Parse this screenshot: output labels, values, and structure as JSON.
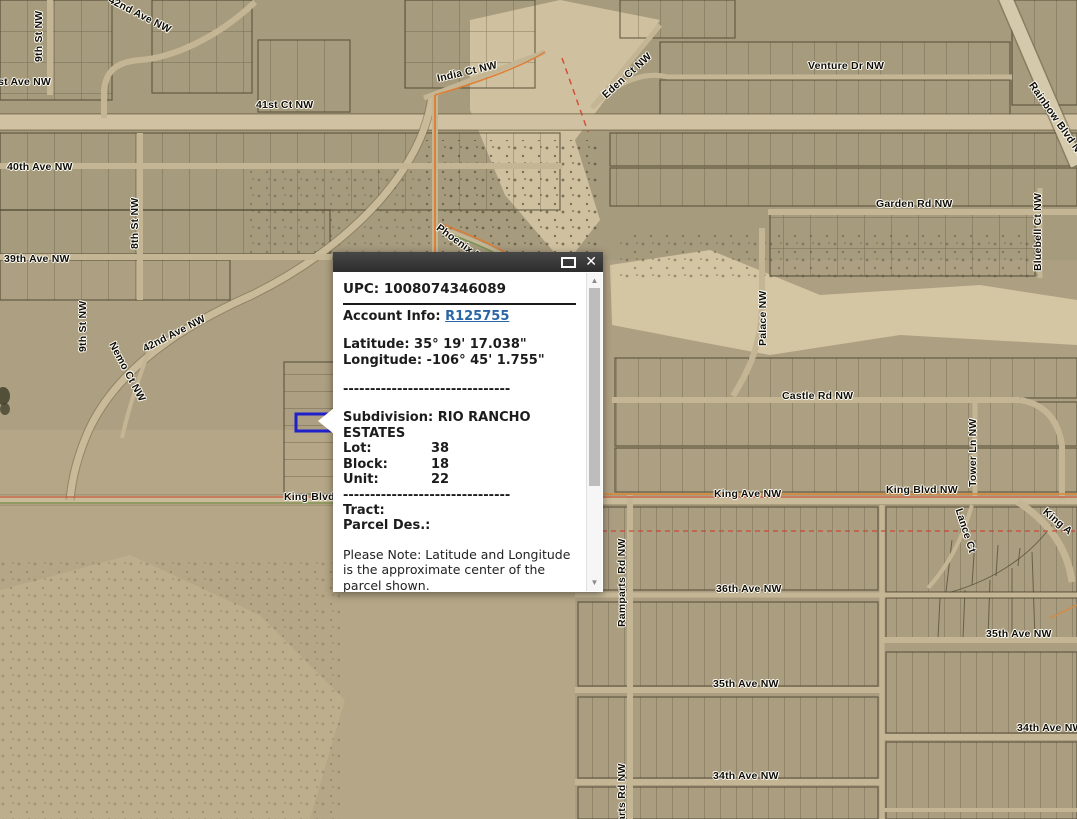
{
  "app": {
    "type": "parcel-map-viewer"
  },
  "popup": {
    "upc_line": "UPC: 1008074346089",
    "account_info_label": "Account Info:",
    "account_info_link": "R125755",
    "latitude_line": "Latitude: 35° 19' 17.038\"",
    "longitude_line": "Longitude: -106° 45' 1.755\"",
    "separator": "-------------------------------",
    "subdivision_label": "Subdivision:",
    "subdivision_value": "RIO RANCHO ESTATES",
    "fields": [
      {
        "label": "Lot:",
        "value": "38"
      },
      {
        "label": "Block:",
        "value": "18"
      },
      {
        "label": "Unit:",
        "value": "22"
      }
    ],
    "tract_label": "Tract:",
    "parcel_des_label": "Parcel Des.:",
    "note": "Please Note: Latitude and Longitude is the approximate center of the parcel shown.",
    "icons": {
      "maximize": "restore-window-icon",
      "close_glyph": "✕",
      "scroll_up_glyph": "▲",
      "scroll_down_glyph": "▼"
    },
    "colors": {
      "titlebar": "#3a3a3a",
      "link": "#2a66a5"
    }
  },
  "map": {
    "highlight_color": "#2121cc",
    "labels": [
      {
        "text": "9th St NW",
        "x": 33,
        "y": 62,
        "r": -90
      },
      {
        "text": "42nd Ave NW",
        "x": 112,
        "y": -6,
        "r": 27
      },
      {
        "text": "41st Ave NW",
        "x": -14,
        "y": 76,
        "r": 0
      },
      {
        "text": "41st Ct NW",
        "x": 256,
        "y": 99,
        "r": 0
      },
      {
        "text": "India Ct NW",
        "x": 436,
        "y": 73,
        "r": -13
      },
      {
        "text": "Eden Ct NW",
        "x": 600,
        "y": 92,
        "r": -42
      },
      {
        "text": "Venture Dr NW",
        "x": 808,
        "y": 60,
        "r": 0
      },
      {
        "text": "Rainbow Blvd NW",
        "x": 1036,
        "y": 80,
        "r": 55
      },
      {
        "text": "40th Ave NW",
        "x": 7,
        "y": 161,
        "r": 0
      },
      {
        "text": "8th St NW",
        "x": 129,
        "y": 249,
        "r": -90
      },
      {
        "text": "39th Ave NW",
        "x": 4,
        "y": 253,
        "r": 0
      },
      {
        "text": "9th St NW",
        "x": 77,
        "y": 352,
        "r": -90
      },
      {
        "text": "42nd Ave NW",
        "x": 141,
        "y": 344,
        "r": -27
      },
      {
        "text": "Nemo Ct NW",
        "x": 117,
        "y": 340,
        "r": 62
      },
      {
        "text": "Phoenix Dr",
        "x": 441,
        "y": 222,
        "r": 36
      },
      {
        "text": "Garden Rd NW",
        "x": 876,
        "y": 198,
        "r": 0
      },
      {
        "text": "Bluebell Ct NW",
        "x": 1032,
        "y": 271,
        "r": -90
      },
      {
        "text": "Palace NW",
        "x": 757,
        "y": 346,
        "r": -90
      },
      {
        "text": "Castle Rd NW",
        "x": 782,
        "y": 390,
        "r": 0
      },
      {
        "text": "King Blvd NW",
        "x": 284,
        "y": 491,
        "r": 0
      },
      {
        "text": "King Ave NW",
        "x": 714,
        "y": 488,
        "r": 0
      },
      {
        "text": "King Blvd NW",
        "x": 886,
        "y": 484,
        "r": 0
      },
      {
        "text": "Tower Ln NW",
        "x": 967,
        "y": 487,
        "r": -90
      },
      {
        "text": "Lance Ct",
        "x": 964,
        "y": 507,
        "r": 72
      },
      {
        "text": "King A",
        "x": 1048,
        "y": 506,
        "r": 40
      },
      {
        "text": "Ramparts Rd NW",
        "x": 616,
        "y": 627,
        "r": -90
      },
      {
        "text": "36th Ave NW",
        "x": 716,
        "y": 583,
        "r": 0
      },
      {
        "text": "35th Ave NW",
        "x": 986,
        "y": 628,
        "r": 0
      },
      {
        "text": "35th Ave NW",
        "x": 713,
        "y": 678,
        "r": 0
      },
      {
        "text": "34th Ave NW",
        "x": 1017,
        "y": 722,
        "r": 0
      },
      {
        "text": "34th Ave NW",
        "x": 713,
        "y": 770,
        "r": 0
      },
      {
        "text": "Ramparts Rd NW",
        "x": 616,
        "y": 852,
        "r": -90
      }
    ]
  }
}
